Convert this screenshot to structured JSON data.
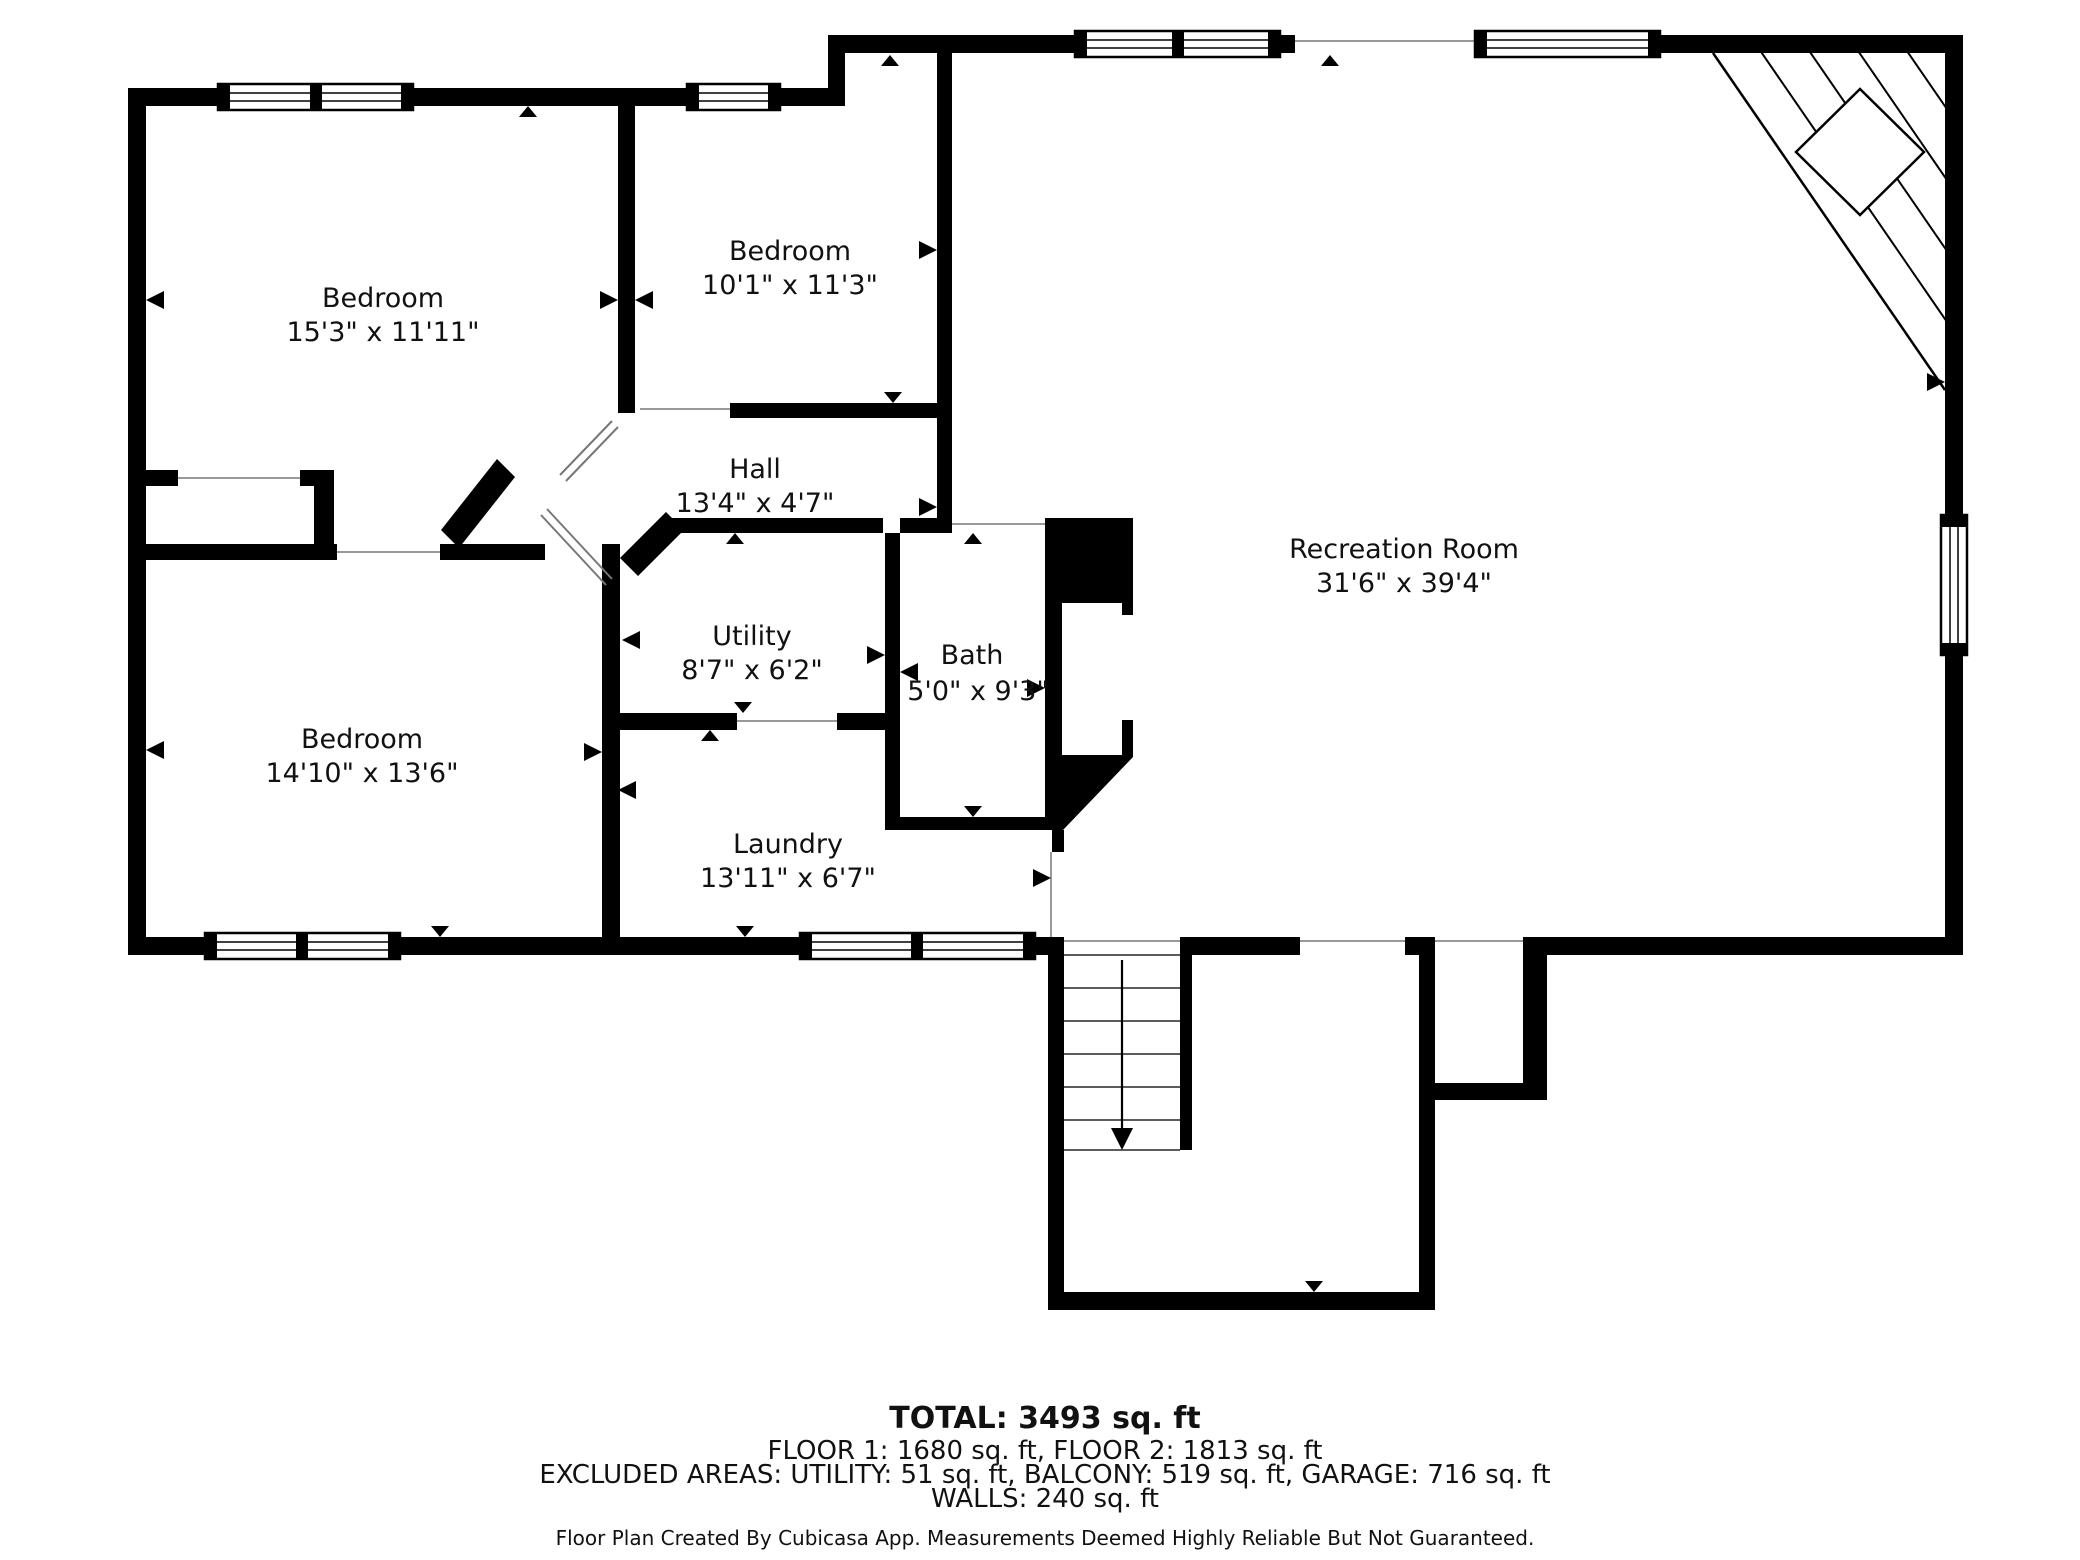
{
  "page": {
    "background": "#ffffff",
    "wall_color": "#000000",
    "opening_line_color": "#999999",
    "text_color": "#111111"
  },
  "rooms": [
    {
      "id": "bedroom-1",
      "name": "Bedroom",
      "dims": "15'3\" x 11'11\""
    },
    {
      "id": "bedroom-2",
      "name": "Bedroom",
      "dims": "10'1\" x 11'3\""
    },
    {
      "id": "hall",
      "name": "Hall",
      "dims": "13'4\" x 4'7\""
    },
    {
      "id": "utility",
      "name": "Utility",
      "dims": "8'7\" x 6'2\""
    },
    {
      "id": "bath",
      "name": "Bath",
      "dims": "5'0\" x 9'3\""
    },
    {
      "id": "bedroom-3",
      "name": "Bedroom",
      "dims": "14'10\" x 13'6\""
    },
    {
      "id": "laundry",
      "name": "Laundry",
      "dims": "13'11\" x 6'7\""
    },
    {
      "id": "recreation-room",
      "name": "Recreation Room",
      "dims": "31'6\" x 39'4\""
    }
  ],
  "footer": {
    "total": "TOTAL: 3493 sq. ft",
    "floors": "FLOOR 1: 1680 sq. ft, FLOOR 2: 1813 sq. ft",
    "excluded": "EXCLUDED AREAS: UTILITY: 51 sq. ft, BALCONY: 519 sq. ft, GARAGE: 716 sq. ft",
    "walls": "WALLS: 240 sq. ft",
    "disclaimer": "Floor Plan Created By Cubicasa App. Measurements Deemed Highly Reliable But Not Guaranteed."
  }
}
